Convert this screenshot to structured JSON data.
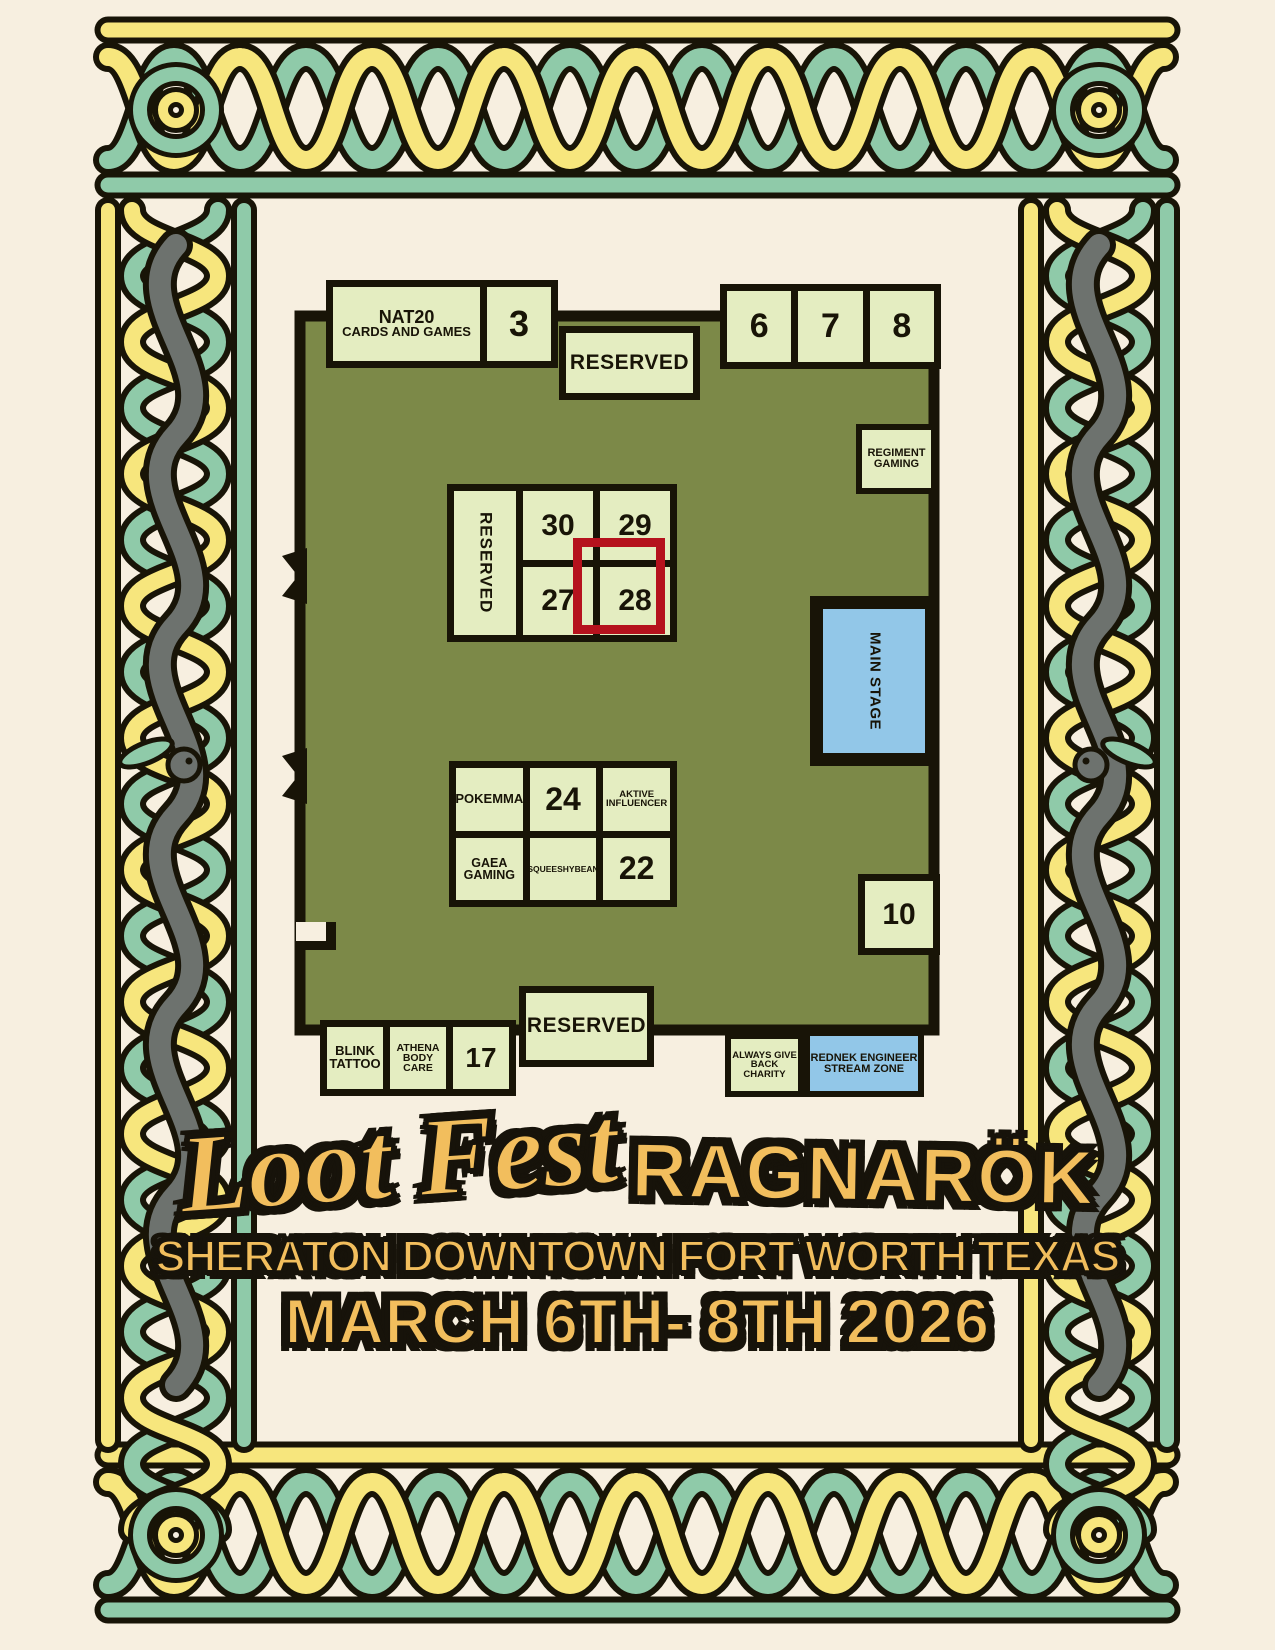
{
  "poster": {
    "title_script": "Loot Fest",
    "title_caps": "RAGNARÖK",
    "venue_line": "SHERATON DOWNTOWN FORT WORTH TEXAS",
    "date_line": "MARCH 6TH- 8TH 2026"
  },
  "floor_map": {
    "booths": {
      "nat20_l1": "NAT20",
      "nat20_l2": "CARDS AND GAMES",
      "b3": "3",
      "b6": "6",
      "b7": "7",
      "b8": "8",
      "b10": "10",
      "b17": "17",
      "b22": "22",
      "b24": "24",
      "b27": "27",
      "b28": "28",
      "b29": "29",
      "b30": "30",
      "reserved_top": "RESERVED",
      "reserved_mid": "RESERVED",
      "reserved_bottom": "RESERVED",
      "regiment_l1": "REGIMENT",
      "regiment_l2": "GAMING",
      "main_stage": "MAIN STAGE",
      "pokemma": "POKEMMA",
      "aktive_l1": "AKTIVE",
      "aktive_l2": "INFLUENCER",
      "gaea_l1": "GAEA",
      "gaea_l2": "GAMING",
      "squeeshybean": "SQUEESHYBEAN",
      "blink_l1": "BLINK",
      "blink_l2": "TATTOO",
      "athena_l1": "ATHENA",
      "athena_l2": "BODY CARE",
      "always_l1": "ALWAYS GIVE",
      "always_l2": "BACK CHARITY",
      "rednek_l1": "REDNEK ENGINEER",
      "rednek_l2": "STREAM ZONE"
    },
    "highlight": {
      "booth": "28",
      "color": "#b5121d"
    }
  },
  "colors": {
    "background": "#f7efe0",
    "floor_green": "#7c8948",
    "booth_fill": "#e4edc1",
    "stage_blue": "#92c7e8",
    "highlight_red": "#b5121d",
    "title_gold": "#f2be5d",
    "border_yellow": "#f7e67d",
    "border_teal": "#8fcaa9",
    "border_gray": "#6d726e",
    "ink": "#181407"
  }
}
